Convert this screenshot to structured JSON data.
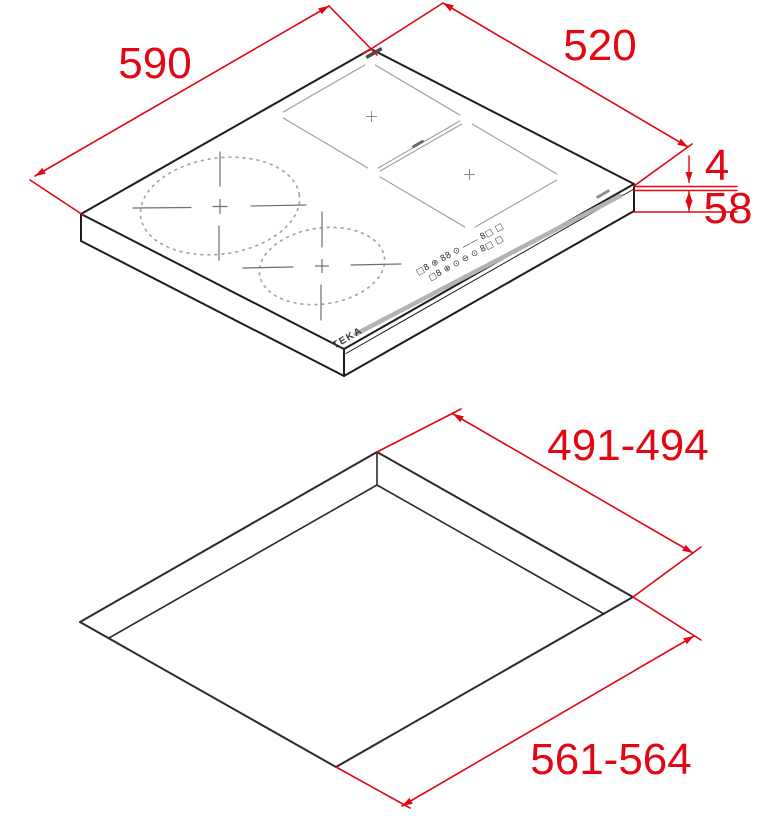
{
  "figure": {
    "title": "induction hob installation drawing",
    "brand_logo": "TEKA",
    "colors": {
      "dimension_red": "#e30613",
      "line_black": "#1d1d1b",
      "zone_gray": "#9d9d9c",
      "trim_silver": "#b3b3b3"
    },
    "top_view": {
      "width_mm": "590",
      "depth_mm": "520",
      "glass_thickness_mm": "4",
      "body_height_mm": "58"
    },
    "cutout_view": {
      "cutout_depth_mm": "491-494",
      "cutout_width_mm": "561-564"
    },
    "control_panel": {
      "row1": "□8  ⊛ 88 ⊙ —— 8□ □",
      "row2": "□8  ⊕ ⊙ ⊖ ⊙  8□ □"
    }
  }
}
